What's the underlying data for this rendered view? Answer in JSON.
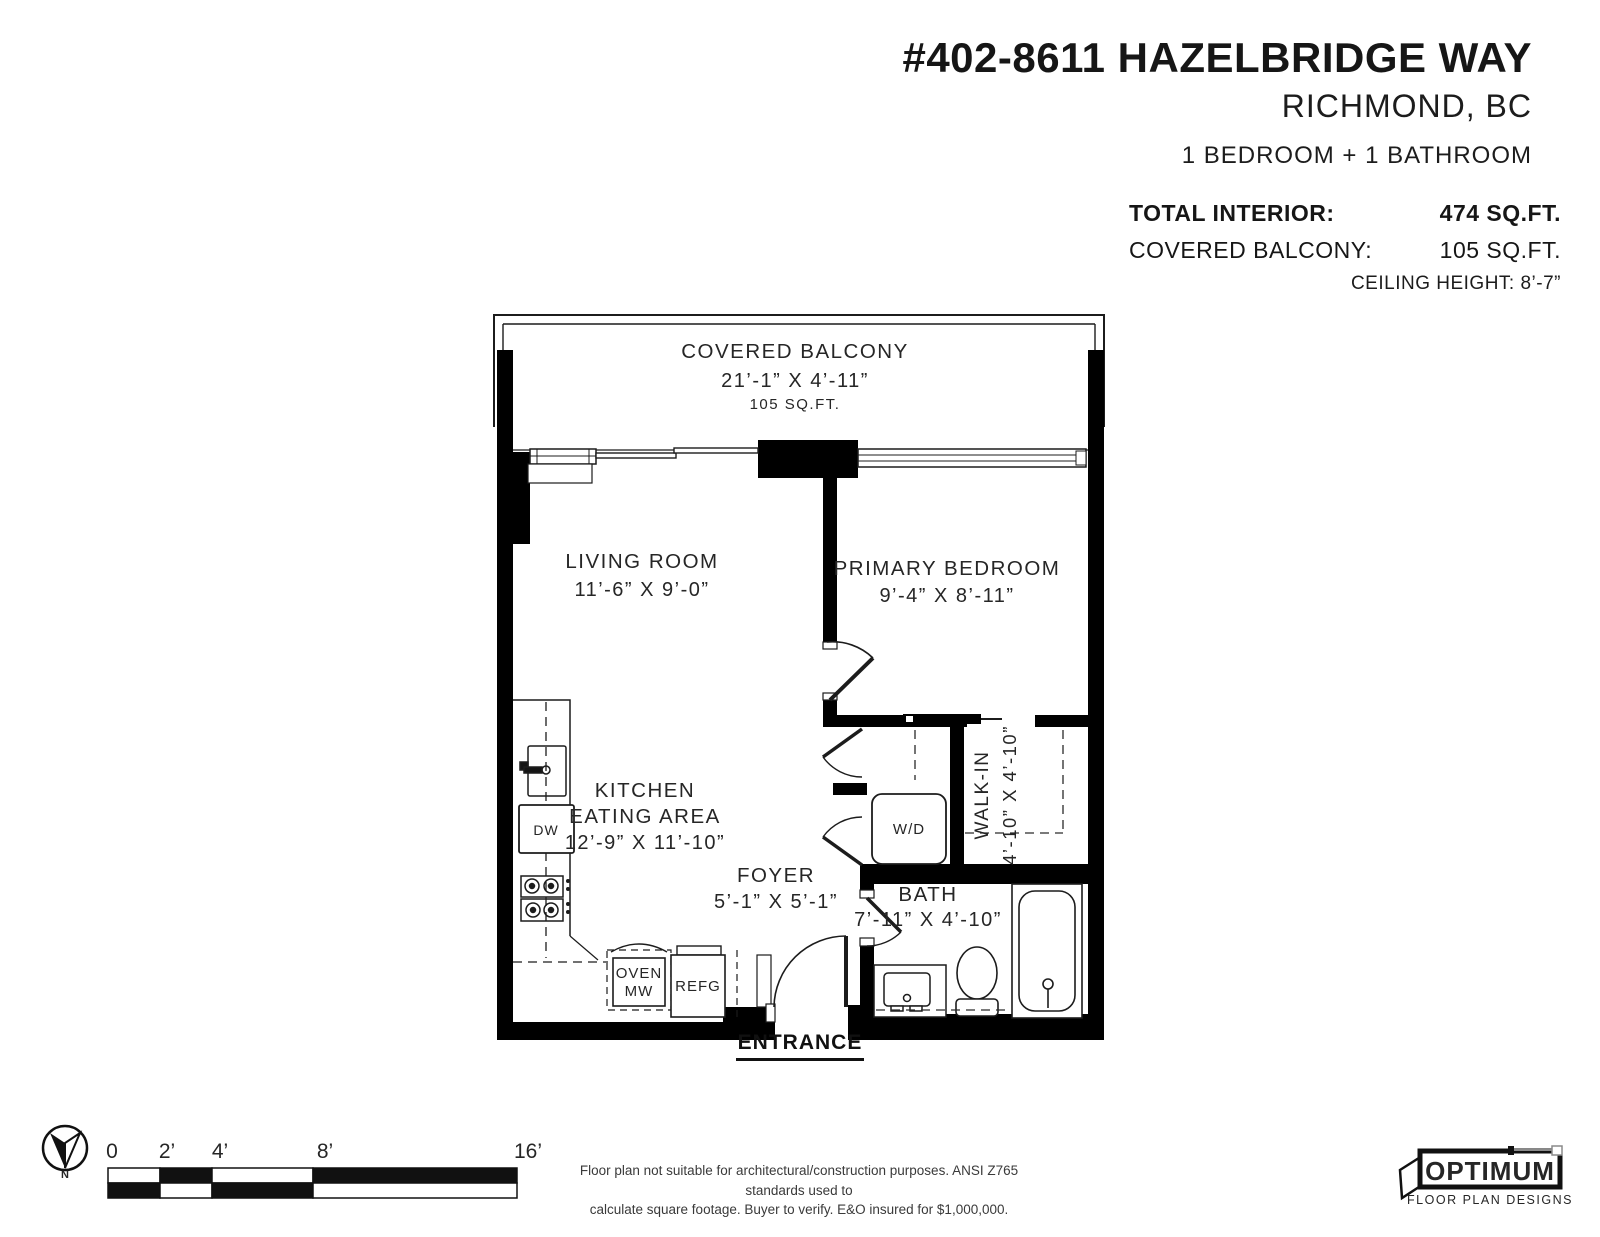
{
  "header": {
    "address": "#402-8611 HAZELBRIDGE WAY",
    "city": "RICHMOND, BC",
    "configuration": "1 BEDROOM + 1 BATHROOM",
    "total_interior_label": "TOTAL INTERIOR:",
    "total_interior_value": "474 SQ.FT.",
    "covered_balcony_label": "COVERED BALCONY:",
    "covered_balcony_value": "105 SQ.FT.",
    "ceiling_height": "CEILING HEIGHT: 8’-7”"
  },
  "floor_plan": {
    "balcony": {
      "name": "COVERED BALCONY",
      "dims": "21’-1” X 4’-11”",
      "area": "105 SQ.FT."
    },
    "living_room": {
      "name": "LIVING ROOM",
      "dims": "11’-6” X 9’-0”"
    },
    "primary_bedroom": {
      "name": "PRIMARY BEDROOM",
      "dims": "9’-4” X 8’-11”"
    },
    "kitchen": {
      "name_line1": "KITCHEN",
      "name_line2": "EATING AREA",
      "dims": "12’-9” X 11’-10”"
    },
    "foyer": {
      "name": "FOYER",
      "dims": "5’-1” X 5’-1”"
    },
    "bath": {
      "name": "BATH",
      "dims": "7’-11” X 4’-10”"
    },
    "walk_in": {
      "name": "WALK-IN",
      "dims": "4’-10” X 4’-10”"
    },
    "fixtures": {
      "washer_dryer": "W/D",
      "dishwasher": "DW",
      "oven_line1": "OVEN",
      "oven_line2": "MW",
      "fridge": "REFG"
    },
    "entrance": "ENTRANCE"
  },
  "footer": {
    "compass_label": "N",
    "scale_labels": [
      "0",
      "2’",
      "4’",
      "8’",
      "16’"
    ],
    "disclaimer_line1": "Floor plan not suitable for architectural/construction purposes. ANSI Z765 standards used to",
    "disclaimer_line2": "calculate square footage. Buyer to verify. E&O insured for $1,000,000.",
    "logo_name": "OPTIMUM",
    "logo_tagline": "FLOOR PLAN DESIGNS"
  },
  "colors": {
    "wall": "#000000",
    "line": "#1c1c1c",
    "text": "#262626",
    "background": "#ffffff"
  }
}
